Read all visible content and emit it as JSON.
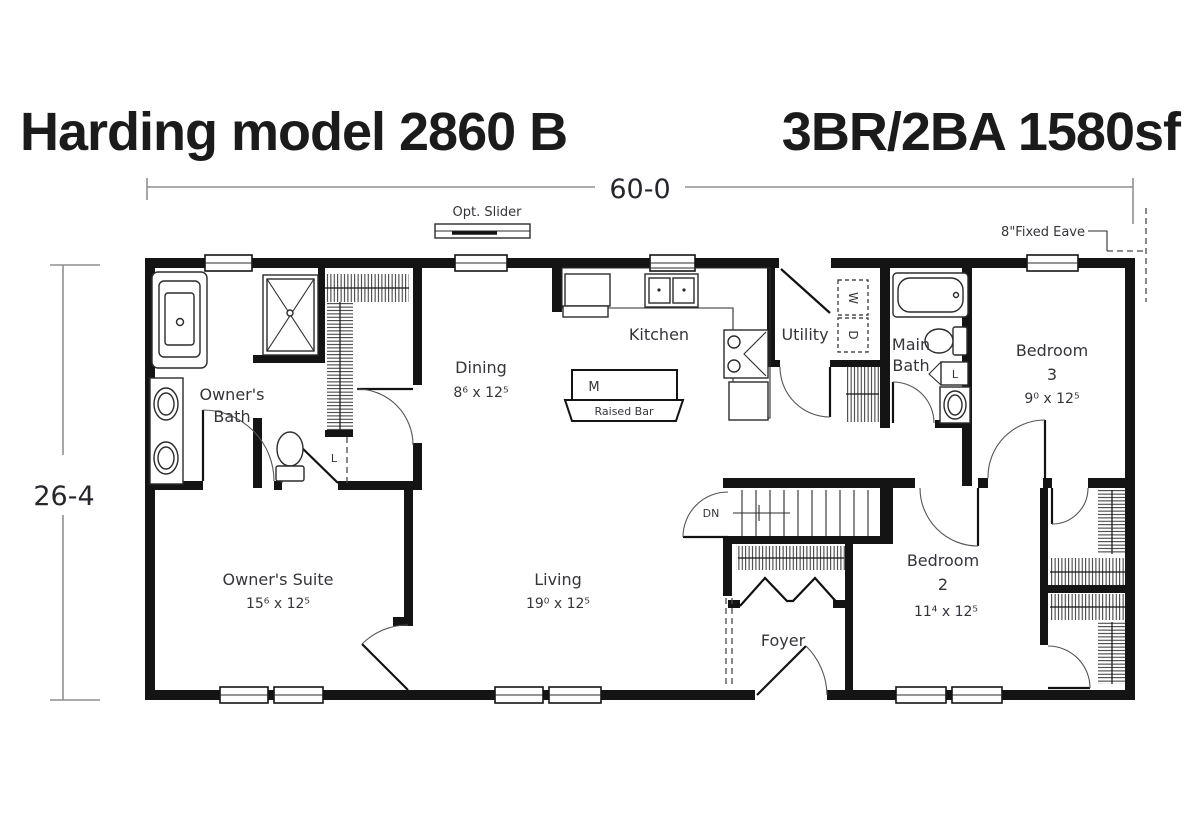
{
  "title": {
    "model": "Harding model 2860 B",
    "specs": "3BR/2BA 1580sf"
  },
  "dimensions": {
    "overall_width": "60-0",
    "overall_depth": "26-4"
  },
  "annotations": {
    "opt_slider": "Opt. Slider",
    "fixed_eave": "8\"Fixed Eave",
    "stairs_down": "DN",
    "washer": "W",
    "dryer": "D",
    "linen": "L",
    "island": "M",
    "raised_bar": "Raised Bar"
  },
  "rooms": {
    "owners_bath": {
      "label_lines": [
        "Owner's",
        "Bath"
      ]
    },
    "dining": {
      "label": "Dining",
      "dims": "8⁶ x 12⁵"
    },
    "kitchen": {
      "label": "Kitchen"
    },
    "utility": {
      "label": "Utility"
    },
    "main_bath": {
      "label_lines": [
        "Main",
        "Bath"
      ]
    },
    "bedroom3": {
      "label_lines": [
        "Bedroom",
        "3"
      ],
      "dims": "9⁰ x 12⁵"
    },
    "owners_suite": {
      "label": "Owner's Suite",
      "dims": "15⁶ x 12⁵"
    },
    "living": {
      "label": "Living",
      "dims": "19⁰ x 12⁵"
    },
    "bedroom2": {
      "label_lines": [
        "Bedroom",
        "2"
      ],
      "dims": "11⁴ x 12⁵"
    },
    "foyer": {
      "label": "Foyer"
    }
  }
}
